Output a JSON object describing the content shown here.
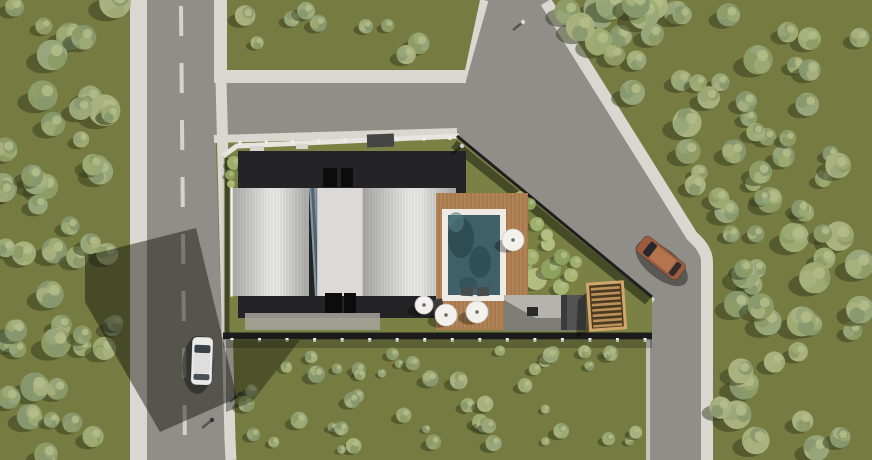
{
  "scene": {
    "width": 872,
    "height": 460,
    "description": "aerial-3d-site-plan-render"
  },
  "palette": {
    "grass": "#767b41",
    "grassPlot": "#7b8045",
    "asphalt": "#908e88",
    "sidewalk": "#d9d7cf",
    "paint": "#d5d4cc",
    "wall": "#e7e5df",
    "fence": "#1b1b1b",
    "roofDark": "#242426",
    "roofEdge": "#a8a8a6",
    "roofMid": "#e8e8e6",
    "centerStrip": "#dbdad8",
    "glassSliver": "#8598a3",
    "pool": "#3f6069",
    "poolDark": "#2b4a50",
    "coping": "#edebe4",
    "deck": "#b28455",
    "pergolaBase": "#4a3a22",
    "pergolaSlat": "#bd9059",
    "pergolaFrame": "#d2a76b",
    "patio": "#b5b3ac",
    "treeShadow": "#333a1d",
    "treeHi": "#b5bd8a",
    "treeTones": [
      "#8e9b65",
      "#9dab72",
      "#a9b17e",
      "#87986e",
      "#97a67b"
    ],
    "bushTones": [
      "#9fb06c",
      "#b2bd80",
      "#8da25f",
      "#a7b573"
    ],
    "carWhiteBody": "#e9eae9",
    "carWhiteRoof": "#dededd",
    "carBrownBody": "#9c5a3e",
    "carBrownRoof": "#b4744d",
    "carGlass": "#394048",
    "shadow": "rgba(13,15,9,0.45)"
  },
  "layers": [
    {
      "t": "rect",
      "name": "ground",
      "x": 0,
      "y": 0,
      "w": 872,
      "h": 460,
      "fill": "$grass"
    },
    {
      "t": "rect",
      "name": "left-road-sidewalk-west",
      "x": 130,
      "y": 0,
      "w": 17,
      "h": 460,
      "fill": "$sidewalk"
    },
    {
      "t": "poly",
      "name": "left-road-asphalt",
      "pts": [
        [
          147,
          0
        ],
        [
          214,
          0
        ],
        [
          214,
          84
        ],
        [
          222,
          340
        ],
        [
          228,
          460
        ],
        [
          147,
          460
        ]
      ],
      "fill": "$asphalt"
    },
    {
      "t": "dash",
      "name": "left-road-center-line",
      "x1": 181,
      "y1": 6,
      "x2": 185,
      "y2": 456,
      "w": 4,
      "dash": "30 27",
      "stroke": "$paint"
    },
    {
      "t": "rect",
      "name": "left-road-sidewalk-east-top",
      "x": 214,
      "y": 0,
      "w": 13,
      "h": 76,
      "fill": "$sidewalk"
    },
    {
      "t": "poly",
      "name": "junction-and-right-road-asphalt",
      "pts": [
        [
          214,
          70
        ],
        [
          468,
          70
        ],
        [
          482,
          0
        ],
        [
          548,
          0
        ],
        [
          694,
          238
        ],
        [
          710,
          254
        ],
        [
          710,
          460
        ],
        [
          649,
          460
        ],
        [
          649,
          306
        ],
        [
          452,
          141
        ],
        [
          214,
          141
        ]
      ],
      "fill": "$asphalt"
    },
    {
      "t": "path",
      "name": "right-road-outer-sidewalk",
      "d": "M546,2 L692,236 Q707,249 707,262 L707,460",
      "stroke": "$sidewalk",
      "w": 12
    },
    {
      "t": "path",
      "name": "right-road-lower-curb",
      "d": "M648,308 L648,460",
      "stroke": "$sidewalk",
      "w": 4,
      "op": 0.8
    },
    {
      "t": "path",
      "name": "left-road-sidewalk-east-lower",
      "d": "M221,80 L230,440 L231,460",
      "stroke": "$sidewalk",
      "w": 11
    },
    {
      "t": "rect",
      "name": "junction-sidewalk",
      "x": 214,
      "y": 70,
      "w": 252,
      "h": 13,
      "fill": "$sidewalk"
    },
    {
      "t": "path",
      "name": "upper-branch-west-sidewalk",
      "d": "M461,82 L484,0",
      "stroke": "$sidewalk",
      "w": 9
    },
    {
      "t": "poly",
      "name": "top-grass-strip",
      "pts": [
        [
          227,
          0
        ],
        [
          480,
          0
        ],
        [
          465,
          70
        ],
        [
          227,
          70
        ]
      ],
      "fill": "$grass"
    },
    {
      "t": "path",
      "name": "plot-north-sidewalk",
      "d": "M214,139 L457,132",
      "stroke": "$sidewalk",
      "w": 8
    },
    {
      "t": "path",
      "name": "plot-diagonal-sidewalk",
      "d": "M452,138 L652,303",
      "stroke": "$sidewalk",
      "w": 10
    },
    {
      "t": "poly",
      "name": "plot-grass",
      "pts": [
        [
          223,
          156
        ],
        [
          237,
          146
        ],
        [
          457,
          135
        ],
        [
          652,
          297
        ],
        [
          652,
          338
        ],
        [
          223,
          338
        ]
      ],
      "fill": "$grassPlot"
    },
    {
      "t": "path",
      "name": "plot-north-wall",
      "d": "M223,156 L237,146 L459,136",
      "stroke": "$wall",
      "w": 5
    },
    {
      "t": "posts",
      "name": "north-wall-posts",
      "x1": 240,
      "y1": 143,
      "x2": 450,
      "y2": 138,
      "n": 9
    },
    {
      "t": "rect",
      "name": "entrance-gate",
      "x": 367,
      "y": 134,
      "w": 27,
      "h": 13,
      "fill": "#454545",
      "rot": -2
    },
    {
      "t": "path",
      "name": "plot-west-wall",
      "d": "M223,156 L223,337",
      "stroke": "#d2d0c9",
      "w": 3,
      "op": 0.9
    },
    {
      "t": "path",
      "name": "plot-west-wall-shadow",
      "d": "M227,158 L227,337",
      "stroke": "rgba(0,0,0,0.45)",
      "w": 5
    },
    {
      "t": "path",
      "name": "plot-diagonal-fence",
      "d": "M457,136 L652,297",
      "stroke": "#1f1f1f",
      "w": 3
    },
    {
      "t": "path",
      "name": "plot-diagonal-hedge-shadow",
      "d": "M454,144 L648,301",
      "stroke": "rgba(34,40,20,0.6)",
      "w": 9
    },
    {
      "t": "path",
      "name": "plot-south-fence",
      "d": "M223,336 L652,336",
      "stroke": "$fence",
      "w": 7
    },
    {
      "t": "posts",
      "name": "south-fence-posts",
      "x1": 232,
      "y1": 340,
      "x2": 645,
      "y2": 340,
      "n": 16
    },
    {
      "t": "rect",
      "name": "south-fence-shadow",
      "x": 223,
      "y": 340,
      "w": 429,
      "h": 8,
      "fill": "rgba(0,0,0,0.22)"
    },
    {
      "t": "bushes",
      "name": "hedge-northwest",
      "pts": [
        [
          234,
          163,
          7
        ],
        [
          246,
          166,
          6
        ],
        [
          258,
          162,
          7
        ],
        [
          271,
          167,
          6
        ],
        [
          283,
          163,
          5
        ],
        [
          295,
          166,
          4
        ],
        [
          230,
          175,
          5
        ],
        [
          231,
          184,
          4
        ],
        [
          430,
          160,
          7
        ],
        [
          443,
          157,
          6
        ],
        [
          452,
          162,
          5
        ],
        [
          420,
          164,
          5
        ]
      ]
    },
    {
      "t": "bushes",
      "name": "garden-east",
      "pts": [
        [
          519,
          268,
          13
        ],
        [
          536,
          279,
          11
        ],
        [
          551,
          269,
          10
        ],
        [
          561,
          287,
          8
        ],
        [
          531,
          257,
          8
        ],
        [
          548,
          244,
          7
        ],
        [
          562,
          257,
          8
        ],
        [
          571,
          275,
          7
        ],
        [
          537,
          224,
          7
        ],
        [
          547,
          235,
          6
        ],
        [
          530,
          204,
          6
        ],
        [
          520,
          196,
          5
        ],
        [
          576,
          262,
          6
        ]
      ]
    },
    {
      "t": "rect",
      "name": "building-flat-roof",
      "x": 238,
      "y": 151,
      "w": 228,
      "h": 167,
      "fill": "$roofDark"
    },
    {
      "t": "rect",
      "name": "parapet-mark-1",
      "x": 250,
      "y": 146,
      "w": 14,
      "h": 5,
      "fill": "#d6d5d0"
    },
    {
      "t": "rect",
      "name": "parapet-mark-2",
      "x": 296,
      "y": 144,
      "w": 12,
      "h": 5,
      "fill": "#d6d5d0"
    },
    {
      "t": "rect",
      "name": "roof-hatch-north-1",
      "x": 323,
      "y": 168,
      "w": 14,
      "h": 19,
      "fill": "#0c0c0c"
    },
    {
      "t": "rect",
      "name": "roof-hatch-north-2",
      "x": 341,
      "y": 168,
      "w": 12,
      "h": 19,
      "fill": "#0c0c0c"
    },
    {
      "t": "barrel",
      "name": "barrel-roof-west",
      "x": 231,
      "y": 188,
      "w": 78,
      "h": 108,
      "gap": 3
    },
    {
      "t": "poly",
      "name": "skylight-sliver",
      "pts": [
        [
          309,
          188
        ],
        [
          317,
          188
        ],
        [
          323,
          296
        ],
        [
          315,
          296
        ]
      ],
      "fill": "$glassSliver"
    },
    {
      "t": "poly",
      "name": "skylight-shade",
      "pts": [
        [
          311,
          188
        ],
        [
          314,
          188
        ],
        [
          320,
          296
        ],
        [
          317,
          296
        ]
      ],
      "fill": "rgba(30,45,55,0.5)"
    },
    {
      "t": "rect",
      "name": "roof-center-strip",
      "x": 317,
      "y": 188,
      "w": 46,
      "h": 108,
      "fill": "$centerStrip"
    },
    {
      "t": "path",
      "name": "center-strip-edge-w",
      "d": "M317,188 L317,296",
      "stroke": "rgba(0,0,0,0.15)",
      "w": 1.5
    },
    {
      "t": "path",
      "name": "center-strip-edge-e",
      "d": "M363,188 L363,296",
      "stroke": "rgba(0,0,0,0.15)",
      "w": 1.5
    },
    {
      "t": "barrel",
      "name": "barrel-roof-east",
      "x": 363,
      "y": 188,
      "w": 93,
      "h": 108,
      "gap": 3
    },
    {
      "t": "rect",
      "name": "roof-outline",
      "x": 231,
      "y": 188,
      "w": 1.2,
      "h": 108,
      "fill": "none",
      "stroke": "#f2f2f0"
    },
    {
      "t": "rect",
      "name": "roof-hatch-south-1",
      "x": 325,
      "y": 293,
      "w": 17,
      "h": 20,
      "fill": "#0c0c0c"
    },
    {
      "t": "rect",
      "name": "roof-hatch-south-2",
      "x": 344,
      "y": 293,
      "w": 12,
      "h": 20,
      "fill": "#0c0c0c"
    },
    {
      "t": "rect",
      "name": "south-terrace",
      "x": 245,
      "y": 313,
      "w": 135,
      "h": 17,
      "fill": "#a6a49d",
      "op": 0.85
    },
    {
      "t": "deck",
      "name": "pool-deck",
      "x": 436,
      "y": 193,
      "w": 92,
      "h": 137
    },
    {
      "t": "rect",
      "name": "pool-coping",
      "x": 442,
      "y": 209,
      "w": 64,
      "h": 92,
      "fill": "$coping"
    },
    {
      "t": "rect",
      "name": "pool-water",
      "x": 448,
      "y": 215,
      "w": 52,
      "h": 80,
      "fill": "$pool"
    },
    {
      "t": "ell",
      "name": "pool-reflection-1",
      "cx": 461,
      "cy": 238,
      "rx": 13,
      "ry": 20,
      "fill": "$poolDark",
      "op": 0.85
    },
    {
      "t": "ell",
      "name": "pool-reflection-2",
      "cx": 480,
      "cy": 262,
      "rx": 11,
      "ry": 16,
      "fill": "$poolDark",
      "op": 0.7
    },
    {
      "t": "ell",
      "name": "pool-reflection-3",
      "cx": 468,
      "cy": 284,
      "rx": 9,
      "ry": 7,
      "fill": "#315159",
      "op": 0.8
    },
    {
      "t": "ell",
      "name": "pool-light-patch",
      "cx": 456,
      "cy": 222,
      "rx": 8,
      "ry": 10,
      "fill": "#567f86",
      "op": 0.6
    },
    {
      "t": "rect",
      "name": "sun-lounger-1",
      "x": 461,
      "y": 287,
      "w": 12,
      "h": 9,
      "fill": "#474b4e",
      "rot": 3
    },
    {
      "t": "rect",
      "name": "sun-lounger-2",
      "x": 477,
      "y": 287,
      "w": 12,
      "h": 9,
      "fill": "#474b4e",
      "rot": -2
    },
    {
      "t": "rect",
      "name": "deck-side-table",
      "x": 433,
      "y": 299,
      "w": 10,
      "h": 13,
      "fill": "#3c3c3c",
      "rot": -8
    },
    {
      "t": "poly",
      "name": "patio",
      "pts": [
        [
          504,
          295
        ],
        [
          577,
          295
        ],
        [
          577,
          331
        ],
        [
          504,
          331
        ]
      ],
      "fill": "$patio"
    },
    {
      "t": "poly",
      "name": "patio-shadow",
      "pts": [
        [
          504,
          300
        ],
        [
          536,
          318
        ],
        [
          568,
          318
        ],
        [
          577,
          331
        ],
        [
          504,
          331
        ]
      ],
      "fill": "rgba(0,0,0,0.3)"
    },
    {
      "t": "rect",
      "name": "barbecue",
      "x": 527,
      "y": 307,
      "w": 11,
      "h": 9,
      "fill": "#2a2a2a"
    },
    {
      "t": "rect",
      "name": "outdoor-kitchen-block",
      "x": 561,
      "y": 295,
      "w": 25,
      "h": 35,
      "fill": "#525252"
    },
    {
      "t": "rect",
      "name": "outdoor-kitchen-shade",
      "x": 561,
      "y": 295,
      "w": 6,
      "h": 35,
      "fill": "#3a3a3a"
    },
    {
      "t": "poly",
      "name": "pergola-shadow",
      "pts": [
        [
          578,
          300
        ],
        [
          589,
          290
        ],
        [
          589,
          332
        ],
        [
          576,
          338
        ]
      ],
      "fill": "rgba(0,0,0,0.35)"
    },
    {
      "t": "pergola",
      "name": "pergola",
      "x": 589,
      "y": 283,
      "w": 35,
      "h": 46,
      "rot": -4
    },
    {
      "t": "parasol",
      "name": "parasol-1",
      "cx": 513,
      "cy": 240,
      "r": 11
    },
    {
      "t": "parasol",
      "name": "parasol-2",
      "cx": 446,
      "cy": 315,
      "r": 11
    },
    {
      "t": "parasol",
      "name": "parasol-3",
      "cx": 477,
      "cy": 312,
      "r": 11
    },
    {
      "t": "parasol",
      "name": "parasol-4",
      "cx": 424,
      "cy": 305,
      "r": 9
    },
    {
      "t": "trees",
      "name": "forest-west",
      "x": 2,
      "y": 2,
      "w": 116,
      "h": 454,
      "n": 50,
      "seed": 7,
      "rmin": 8,
      "rmax": 16
    },
    {
      "t": "trees",
      "name": "trees-top-strip",
      "x": 238,
      "y": 4,
      "w": 224,
      "h": 54,
      "n": 9,
      "seed": 11,
      "rmin": 6,
      "rmax": 11
    },
    {
      "t": "trees",
      "name": "forest-northeast",
      "x": 556,
      "y": 2,
      "w": 312,
      "h": 248,
      "n": 55,
      "seed": 23,
      "rmin": 8,
      "rmax": 16,
      "minline": [
        558,
        0.64
      ]
    },
    {
      "t": "trees",
      "name": "forest-southeast",
      "x": 720,
      "y": 250,
      "w": 148,
      "h": 206,
      "n": 24,
      "seed": 31,
      "rmin": 9,
      "rmax": 16
    },
    {
      "t": "trees",
      "name": "shrub-field-south",
      "x": 236,
      "y": 350,
      "w": 400,
      "h": 104,
      "n": 48,
      "seed": 43,
      "rmin": 4,
      "rmax": 9,
      "small": true
    },
    {
      "t": "poly",
      "name": "building-cast-shadow",
      "pts": [
        [
          196,
          228
        ],
        [
          237,
          398
        ],
        [
          160,
          432
        ],
        [
          85,
          302
        ],
        [
          85,
          256
        ]
      ],
      "fill": "$shadow"
    },
    {
      "t": "poly",
      "name": "plot-corner-shadow",
      "pts": [
        [
          226,
          340
        ],
        [
          300,
          340
        ],
        [
          252,
          402
        ],
        [
          226,
          412
        ]
      ],
      "fill": "rgba(13,15,9,0.38)"
    },
    {
      "t": "person",
      "name": "pedestrian-junction",
      "x": 523,
      "y": 22,
      "tone": "#d9d9d6"
    },
    {
      "t": "person",
      "name": "pedestrian-plot-corner",
      "x": 462,
      "y": 146,
      "tone": "#caccc9"
    },
    {
      "t": "person",
      "name": "pedestrian-south-1",
      "x": 240,
      "y": 394,
      "tone": "#2c2c2c"
    },
    {
      "t": "person",
      "name": "pedestrian-south-2",
      "x": 212,
      "y": 420,
      "tone": "#333333"
    },
    {
      "t": "car",
      "name": "car-white",
      "x": 202,
      "y": 361,
      "rot": 2,
      "len": 48,
      "wid": 21,
      "body": "$carWhiteBody",
      "roof": "$carWhiteRoof",
      "glass": "$carGlass"
    },
    {
      "t": "car",
      "name": "car-brown",
      "x": 661,
      "y": 258,
      "rot": -52,
      "len": 52,
      "wid": 20,
      "body": "$carBrownBody",
      "roof": "$carBrownRoof",
      "glass": "#23282c"
    }
  ]
}
